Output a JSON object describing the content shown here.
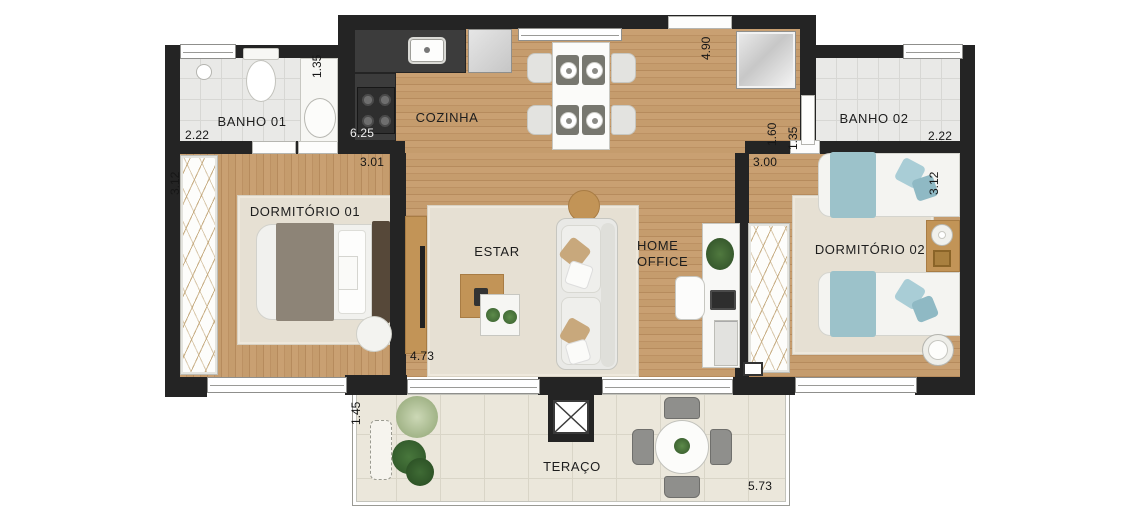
{
  "plan_title": "Apartment floor plan",
  "rooms": {
    "banho01": "BANHO 01",
    "cozinha": "COZINHA",
    "banho02": "BANHO 02",
    "dormitorio01": "DORMITÓRIO 01",
    "estar": "ESTAR",
    "home_office": "HOME OFFICE",
    "dormitorio02": "DORMITÓRIO 02",
    "teraco": "TERAÇO"
  },
  "measurements": {
    "banho01_width": "2.22",
    "banho01_right": "1.35",
    "kitchen_counter": "6.25",
    "dorm01_top": "3.01",
    "dorm01_closet": "3.12",
    "estar_width": "4.73",
    "entry_depth": "4.90",
    "hall_right": "1.60",
    "banho02_left": "1.35",
    "banho02_width": "2.22",
    "dorm02_top": "3.00",
    "dorm02_right": "3.12",
    "terrace_depth": "1.45",
    "terrace_width": "5.73"
  },
  "colors": {
    "wall": "#242424",
    "wood_floor": "#c49a6c",
    "bathroom_tile": "#e9e9e7",
    "terrace_tile": "#ebe7db",
    "rug": "#e6e0d3",
    "kitchen_counter": "#3c3c3c",
    "bed_blue": "#9cc2ca",
    "blanket_taupe": "#8d8477",
    "furniture_wood": "#c29457",
    "plant_green": "#3f6b39"
  }
}
